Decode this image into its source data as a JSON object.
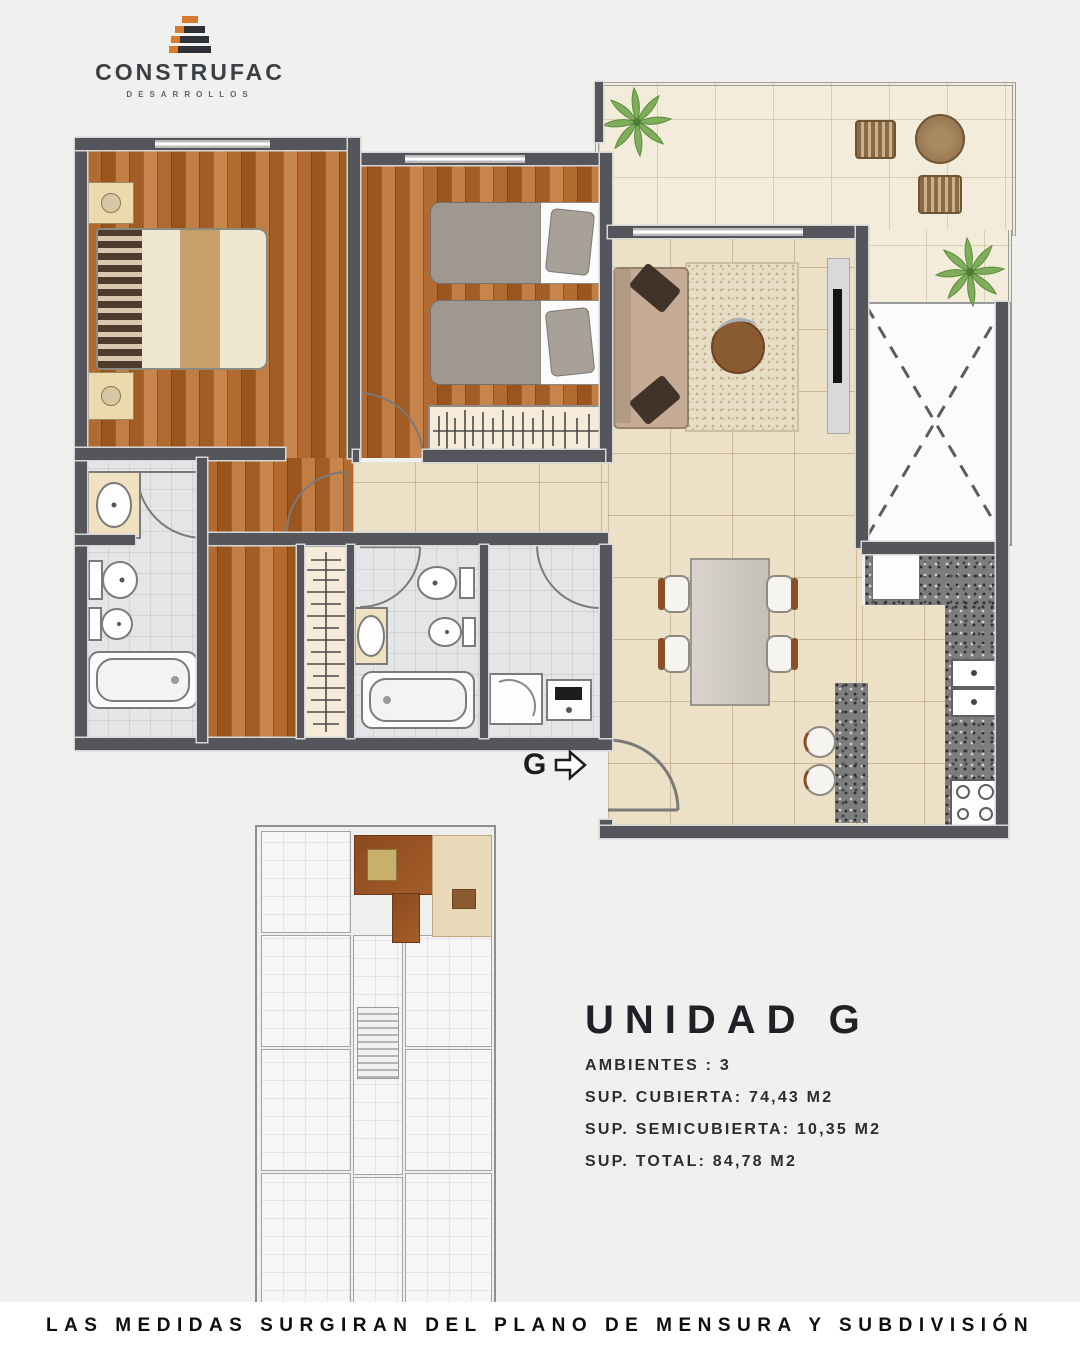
{
  "logo": {
    "name": "CONSTRUFAC",
    "tagline": "DESARROLLOS"
  },
  "unit": {
    "title": "UNIDAD G",
    "specs": [
      {
        "text": "AMBIENTES : 3"
      },
      {
        "text": "SUP. CUBIERTA: 74,43 M2"
      },
      {
        "text": "SUP. SEMICUBIERTA: 10,35 M2"
      },
      {
        "text": "SUP. TOTAL: 84,78 M2"
      }
    ]
  },
  "plan": {
    "entry_marker": "G"
  },
  "footer": {
    "disclaimer": "LAS MEDIDAS SURGIRAN DEL PLANO DE MENSURA Y SUBDIVISIÓN"
  },
  "colors": {
    "wall": "#54565c",
    "wood": "#ad6530",
    "tile-beige": "#ece0c6",
    "tile-cream": "#f4ecda",
    "tile-bath": "#e4e5e7",
    "granite": "#7d7d7d",
    "accent-orange": "#d97b2e",
    "logo-dark": "#2e3237",
    "plant-green": "#7fae5a"
  }
}
